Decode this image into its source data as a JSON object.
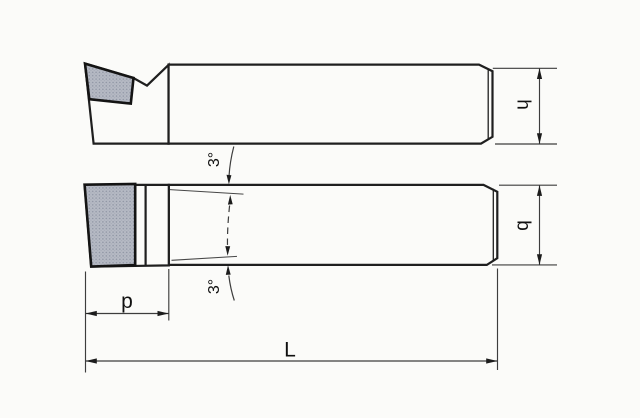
{
  "drawing": {
    "dimension_labels": {
      "shank_height": "h",
      "shank_width": "b",
      "head_length": "p",
      "overall_length": "L",
      "top_taper_angle": "3°",
      "bottom_taper_angle": "3°"
    },
    "colors": {
      "background": "#fbfbf9",
      "outline": "#1f1f1f",
      "dimension_lines": "#3d3d3d",
      "insert_fill": "#b7bbc5",
      "insert_dots": "#8d93a2"
    }
  }
}
